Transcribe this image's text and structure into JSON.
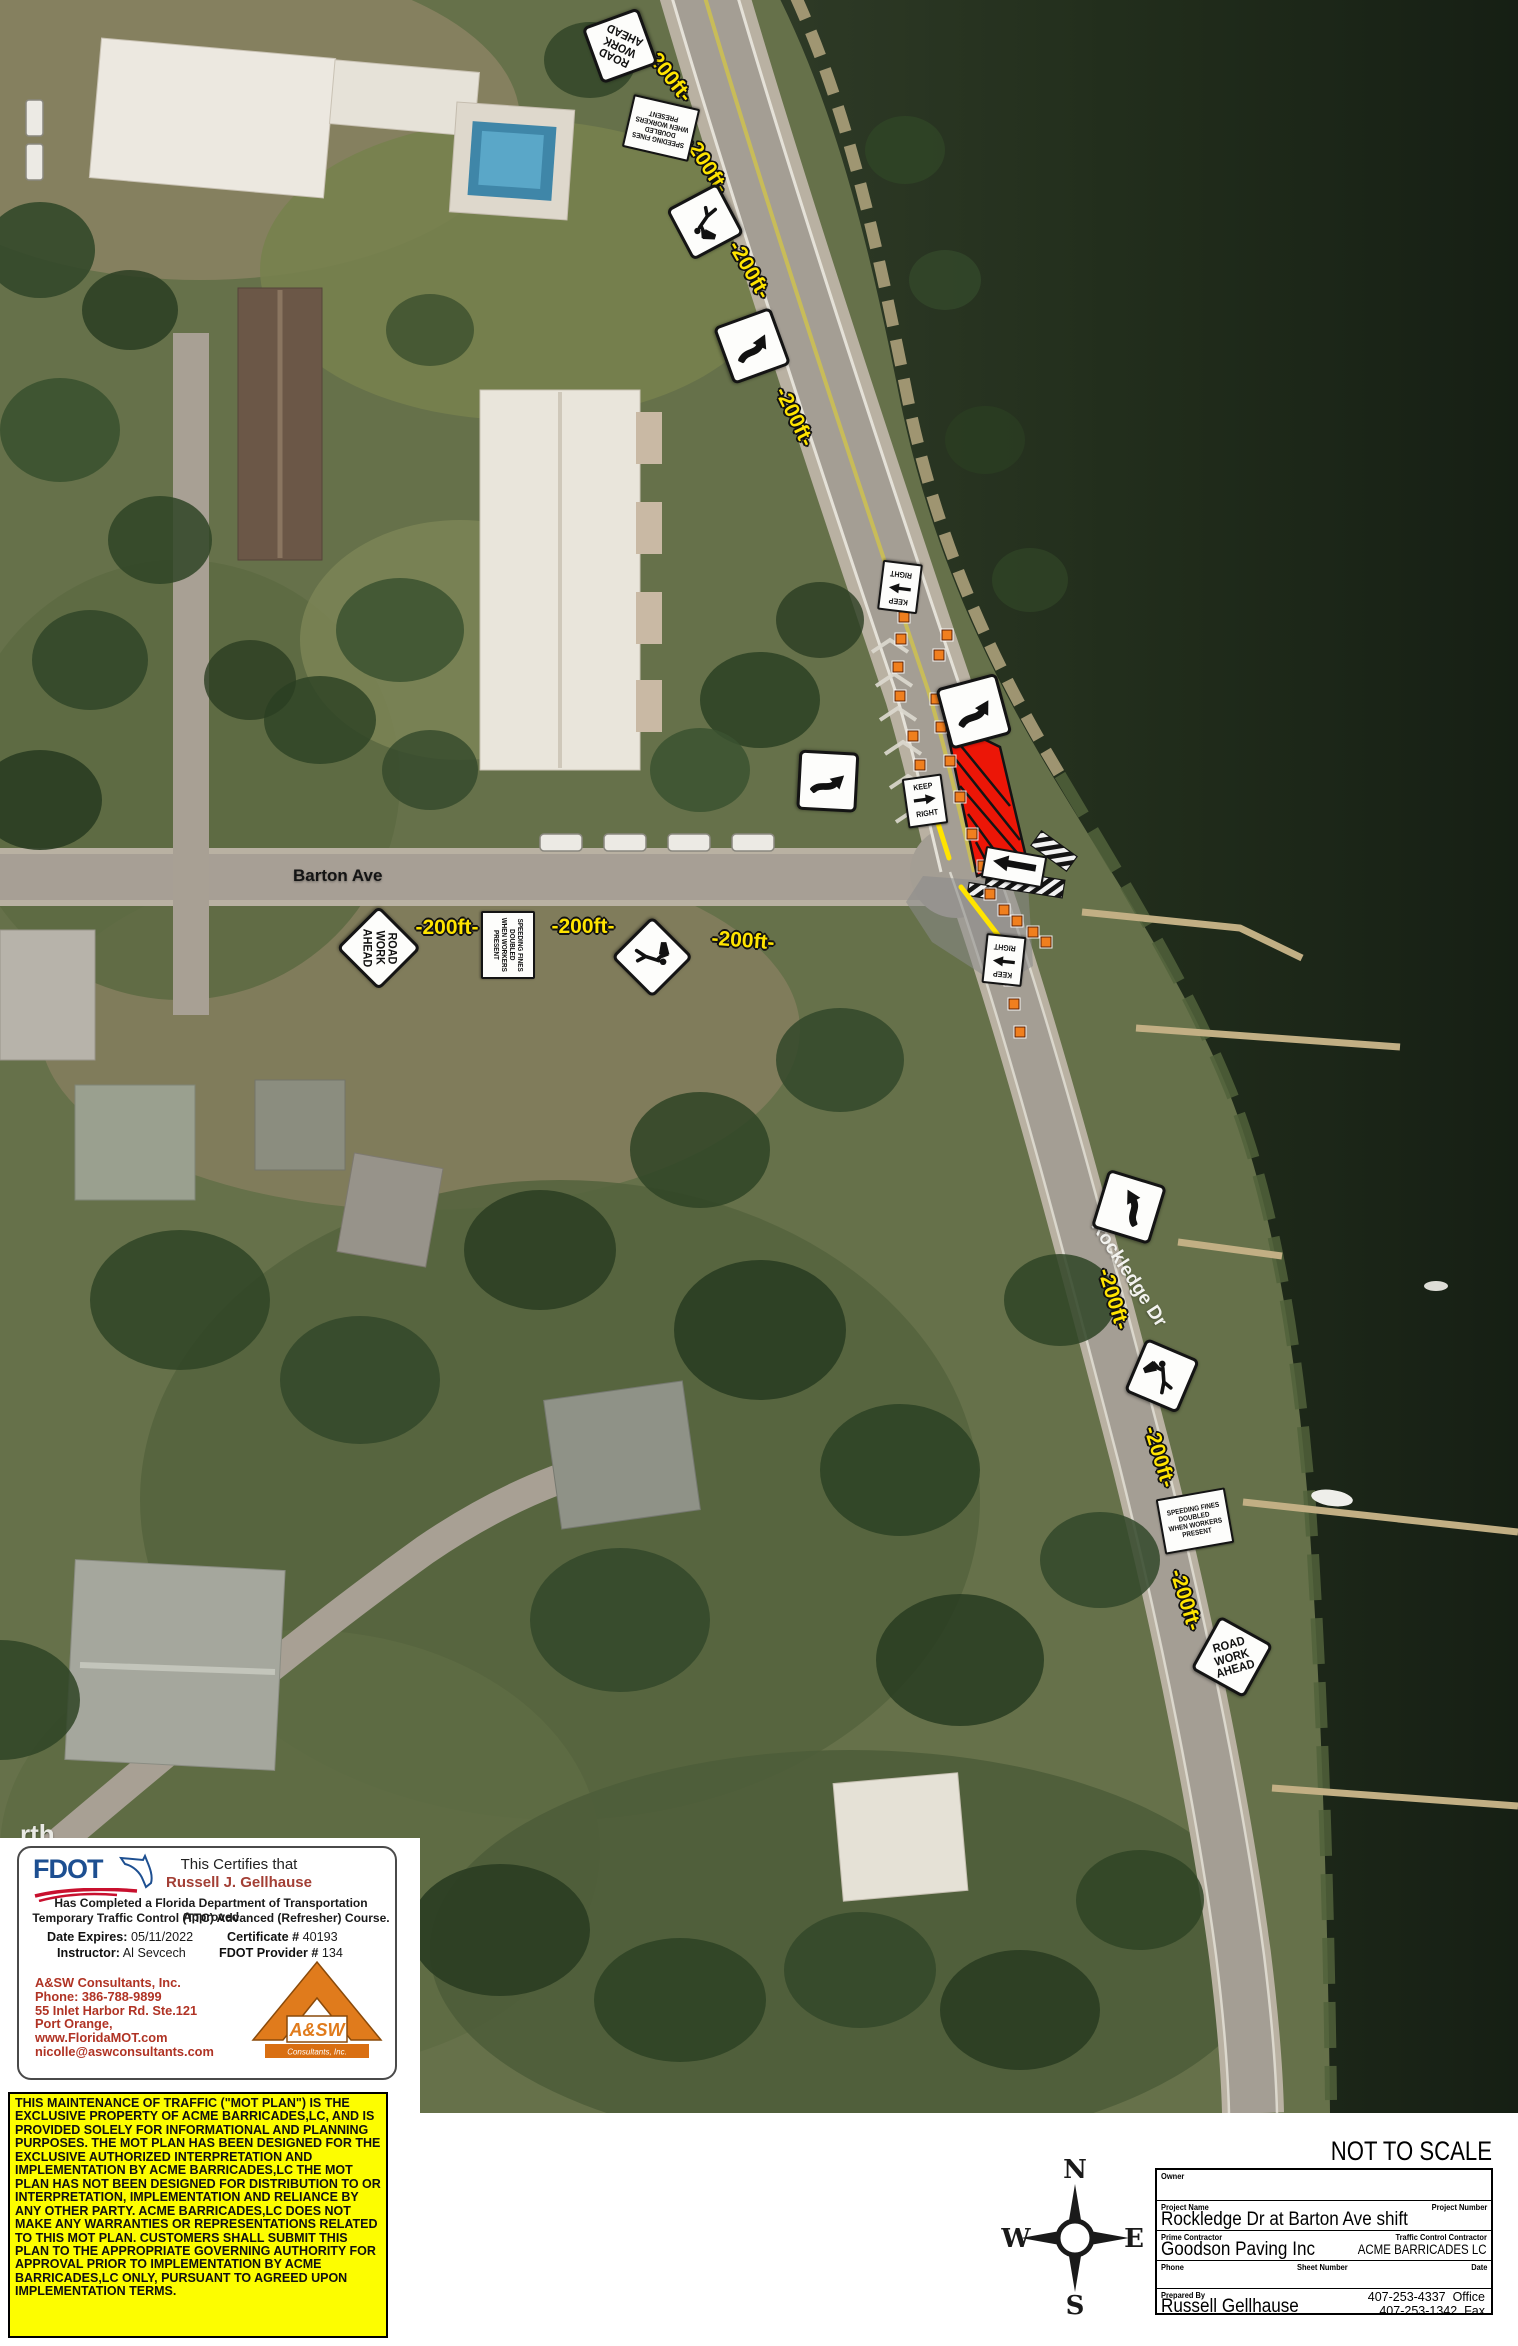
{
  "map": {
    "distance_text": "-200ft-",
    "distance_labels": [
      {
        "x": 668,
        "y": 75,
        "rot": 52
      },
      {
        "x": 706,
        "y": 165,
        "rot": 57
      },
      {
        "x": 749,
        "y": 270,
        "rot": 60
      },
      {
        "x": 794,
        "y": 417,
        "rot": 64
      },
      {
        "x": 447,
        "y": 928,
        "rot": 0
      },
      {
        "x": 583,
        "y": 927,
        "rot": 0
      },
      {
        "x": 743,
        "y": 941,
        "rot": 4
      },
      {
        "x": 1113,
        "y": 1299,
        "rot": 73
      },
      {
        "x": 1159,
        "y": 1457,
        "rot": 73
      },
      {
        "x": 1185,
        "y": 1600,
        "rot": 73
      }
    ],
    "road_labels": [
      {
        "text": "Barton Ave",
        "x": 293,
        "y": 866,
        "rot": 0,
        "color": "#141414",
        "size": 17
      },
      {
        "text": "Rockledge Dr",
        "x": 1067,
        "y": 1263,
        "rot": 57,
        "color": "#f2f2ee",
        "size": 19
      },
      {
        "text": "rth",
        "x": 20,
        "y": 1819,
        "rot": 0,
        "color": "#e9e9e4",
        "size": 26
      }
    ],
    "sign_texts": {
      "road_work_ahead": [
        "ROAD",
        "WORK",
        "AHEAD"
      ],
      "speeding_fines": [
        "SPEEDING FINES",
        "DOUBLED",
        "WHEN WORKERS",
        "PRESENT"
      ],
      "keep_right": [
        "KEEP",
        "RIGHT"
      ]
    },
    "signs": [
      {
        "type": "road-work-ahead",
        "x": 620,
        "y": 46,
        "rot": 205,
        "s": 76
      },
      {
        "type": "speeding-fines",
        "x": 661,
        "y": 128,
        "rot": 193,
        "w": 64,
        "h": 50
      },
      {
        "type": "flagger",
        "x": 705,
        "y": 222,
        "rot": 197,
        "s": 73
      },
      {
        "type": "reverse-curve",
        "x": 752,
        "y": 346,
        "rot": 25,
        "s": 78
      },
      {
        "type": "keep-right",
        "x": 900,
        "y": 587,
        "rot": 187,
        "w": 36,
        "h": 46
      },
      {
        "type": "reverse-curve",
        "x": 828,
        "y": 781,
        "rot": 48,
        "s": 76
      },
      {
        "type": "reverse-curve",
        "x": 974,
        "y": 711,
        "rot": 30,
        "s": 80
      },
      {
        "type": "keep-right",
        "x": 925,
        "y": 801,
        "rot": -8,
        "w": 36,
        "h": 46
      },
      {
        "type": "arrow-board",
        "x": 1014,
        "y": 867,
        "rot": 10,
        "w": 58,
        "h": 28
      },
      {
        "type": "keep-right",
        "x": 1004,
        "y": 960,
        "rot": 186,
        "w": 36,
        "h": 46
      },
      {
        "type": "road-work-ahead",
        "x": 379,
        "y": 948,
        "rot": 90,
        "s": 76
      },
      {
        "type": "speeding-fines",
        "x": 508,
        "y": 945,
        "rot": 90,
        "w": 64,
        "h": 50
      },
      {
        "type": "flagger",
        "x": 652,
        "y": 957,
        "rot": 90,
        "s": 74
      },
      {
        "type": "reverse-curve",
        "x": 1129,
        "y": 1207,
        "rot": -28,
        "s": 78
      },
      {
        "type": "flagger",
        "x": 1162,
        "y": 1376,
        "rot": -22,
        "s": 74
      },
      {
        "type": "speeding-fines",
        "x": 1195,
        "y": 1521,
        "rot": -10,
        "w": 66,
        "h": 52
      },
      {
        "type": "road-work-ahead",
        "x": 1232,
        "y": 1657,
        "rot": -16,
        "s": 78
      }
    ],
    "cones": [
      [
        904,
        617
      ],
      [
        901,
        639
      ],
      [
        898,
        667
      ],
      [
        900,
        696
      ],
      [
        913,
        736
      ],
      [
        920,
        765
      ],
      [
        926,
        793
      ],
      [
        947,
        635
      ],
      [
        939,
        655
      ],
      [
        936,
        699
      ],
      [
        941,
        727
      ],
      [
        950,
        761
      ],
      [
        960,
        797
      ],
      [
        972,
        834
      ],
      [
        983,
        866
      ],
      [
        990,
        894
      ],
      [
        1004,
        910
      ],
      [
        1017,
        921
      ],
      [
        1033,
        932
      ],
      [
        1046,
        942
      ],
      [
        1010,
        980
      ],
      [
        1014,
        1004
      ],
      [
        1020,
        1032
      ]
    ],
    "work_zone": {
      "fill": "#ec1607",
      "points": "945,720 1000,747 1026,857 977,876",
      "hatch": [
        [
          948,
          730,
          1010,
          806
        ],
        [
          953,
          756,
          1020,
          840
        ],
        [
          960,
          786,
          1025,
          862
        ],
        [
          968,
          814,
          1011,
          873
        ],
        [
          976,
          842,
          993,
          874
        ]
      ]
    },
    "shift_area": {
      "fill": "#8a8a8a",
      "opacity": 0.55,
      "points": "923,876 1028,884 1033,966 1000,986 932,942 906,902"
    },
    "barricades": [
      {
        "x": 1032,
        "y": 842,
        "w": 44,
        "h": 18,
        "rot": 36
      },
      {
        "x": 986,
        "y": 874,
        "w": 78,
        "h": 18,
        "rot": 9
      },
      {
        "x": 968,
        "y": 884,
        "w": 20,
        "h": 13,
        "rot": 9
      }
    ],
    "taper_lines": [
      [
        937,
        820,
        949,
        858
      ],
      [
        961,
        887,
        1001,
        939
      ]
    ],
    "colors": {
      "cone": "#f07f1e",
      "label_yellow": "#ffe400",
      "zone_red": "#ec1607"
    }
  },
  "certificate": {
    "logo_text": "FDOT",
    "certifies": "This Certifies that",
    "name": "Russell J. Gellhause",
    "statement_1": "Has Completed a Florida Department of Transportation Approved",
    "statement_2": "Temporary Traffic Control (TTC) Advanced (Refresher) Course.",
    "date_expires_label": "Date Expires:",
    "date_expires": "05/11/2022",
    "certificate_label": "Certificate #",
    "certificate_number": "40193",
    "instructor_label": "Instructor:",
    "instructor": "Al Sevcech",
    "provider_label": "FDOT Provider #",
    "provider_number": "134"
  },
  "consultants": {
    "name": "A&SW Consultants, Inc.",
    "phone": "Phone: 386-788-9899",
    "address": "55 Inlet Harbor Rd. Ste.121",
    "city": "Port Orange,",
    "website": "www.FloridaMOT.com",
    "email": "nicolle@aswconsultants.com",
    "logo_main": "A&SW",
    "logo_sub": "Consultants, Inc."
  },
  "disclaimer": "THIS MAINTENANCE OF TRAFFIC (\"MOT PLAN\") IS THE EXCLUSIVE PROPERTY OF ACME BARRICADES,LC, AND IS PROVIDED SOLELY FOR INFORMATIONAL AND PLANNING PURPOSES. THE MOT PLAN HAS BEEN DESIGNED FOR THE EXCLUSIVE AUTHORIZED INTERPRETATION AND IMPLEMENTATION BY ACME BARRICADES,LC THE MOT PLAN HAS NOT BEEN DESIGNED FOR DISTRIBUTION TO OR INTERPRETATION, IMPLEMENTATION AND RELIANCE BY ANY OTHER PARTY. ACME BARRICADES,LC DOES NOT MAKE ANY WARRANTIES OR REPRESENTATIONS RELATED TO THIS MOT PLAN. CUSTOMERS SHALL SUBMIT THIS PLAN TO THE APPROPRIATE GOVERNING AUTHORITY FOR APPROVAL PRIOR TO IMPLEMENTATION BY ACME BARRICADES,LC ONLY, PURSUANT TO AGREED UPON IMPLEMENTATION TERMS.",
  "scale_note": "NOT TO SCALE",
  "compass": {
    "n": "N",
    "e": "E",
    "s": "S",
    "w": "W"
  },
  "title_block": {
    "owner_label": "Owner",
    "owner": "",
    "project_name_label": "Project Name",
    "project_name": "Rockledge Dr at Barton Ave shift",
    "project_number_label": "Project Number",
    "project_number": "",
    "prime_contractor_label": "Prime Contractor",
    "prime_contractor": "Goodson Paving Inc",
    "tcc_label": "Traffic Control Contractor",
    "tcc": "ACME BARRICADES LC",
    "phone_label": "Phone",
    "phone": "",
    "sheet_number_label": "Sheet Number",
    "sheet_number": "",
    "date_label": "Date",
    "date": "",
    "prepared_by_label": "Prepared By",
    "prepared_by": "Russell Gellhause",
    "office_phone": "407-253-4337",
    "office_suffix": "Office",
    "fax_phone": "407-253-1342",
    "fax_suffix": "Fax"
  }
}
